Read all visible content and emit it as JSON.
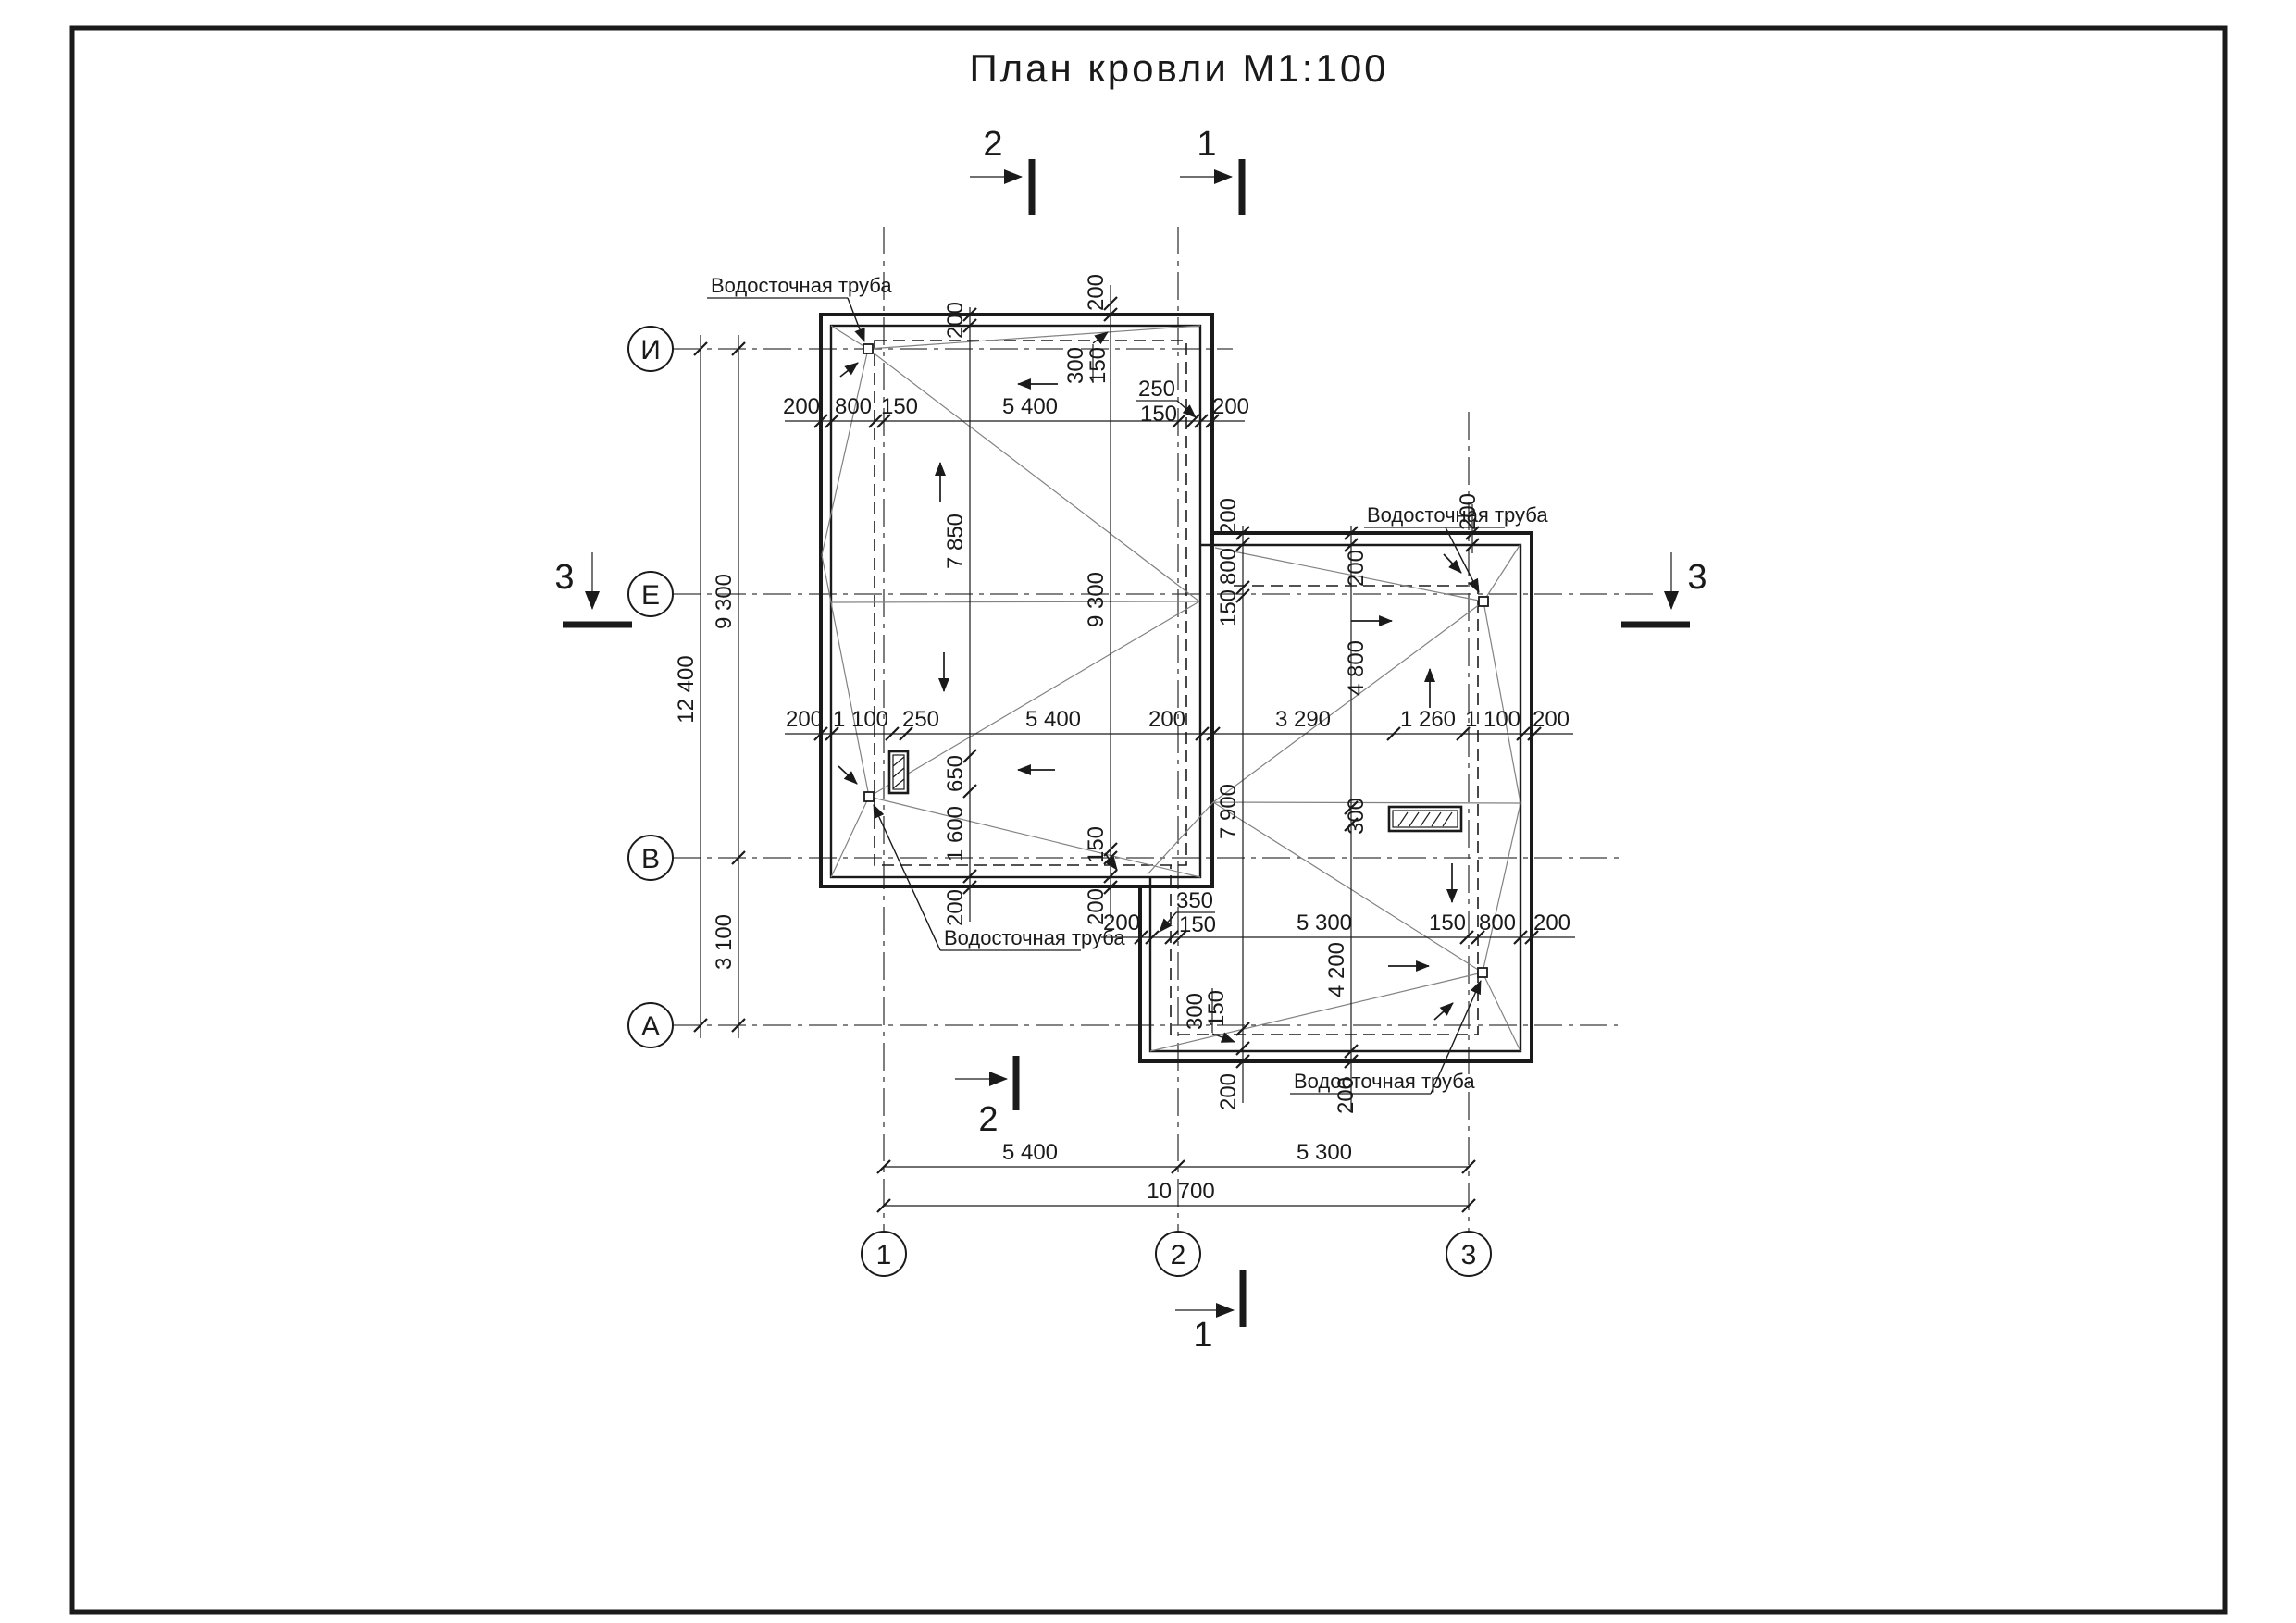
{
  "title": "План кровли М1:100",
  "colors": {
    "ink": "#1a1a1a",
    "thin_line": "#828282",
    "background": "#ffffff"
  },
  "axis_circles": {
    "rows": [
      "И",
      "Е",
      "В",
      "А"
    ],
    "cols": [
      "1",
      "2",
      "3"
    ]
  },
  "section_marks": {
    "top_2": "2",
    "top_1": "1",
    "bottom_2": "2",
    "bottom_1": "1",
    "left_3": "3",
    "right_3": "3"
  },
  "drainpipe_label": "Водосточная труба",
  "dims": {
    "left_margin": {
      "total": "12 400",
      "upper": "9 300",
      "lower": "3 100"
    },
    "lb_top_chain": [
      "200",
      "800",
      "150",
      "5 400",
      "200"
    ],
    "lb_top_callout": {
      "num": "250",
      "den": "150"
    },
    "mid_chain": [
      "200",
      "1 100",
      "250",
      "5 400",
      "200",
      "3 290",
      "1 260",
      "1 100",
      "200"
    ],
    "lb_col_inner": [
      "200",
      "7 850",
      "650",
      "1 600",
      "200"
    ],
    "lb_col_right": [
      "200",
      "9 300",
      "150",
      "200"
    ],
    "lb_tr_callout": {
      "num": "300",
      "den": "150"
    },
    "rb_bottom_chain": [
      "200",
      "5 300",
      "150",
      "800",
      "200"
    ],
    "rb_bottom_callout": {
      "num": "350",
      "den": "150"
    },
    "rb_bl_callout": {
      "num": "300",
      "den": "150"
    },
    "rb_col_left": [
      "200",
      "800",
      "150",
      "7 900",
      "200"
    ],
    "rb_col_mid": [
      "200",
      "4 800",
      "300",
      "4 200",
      "200"
    ],
    "rb_top_right_offset": "200",
    "bottom_spans": [
      "5 400",
      "5 300"
    ],
    "bottom_total": "10 700"
  }
}
